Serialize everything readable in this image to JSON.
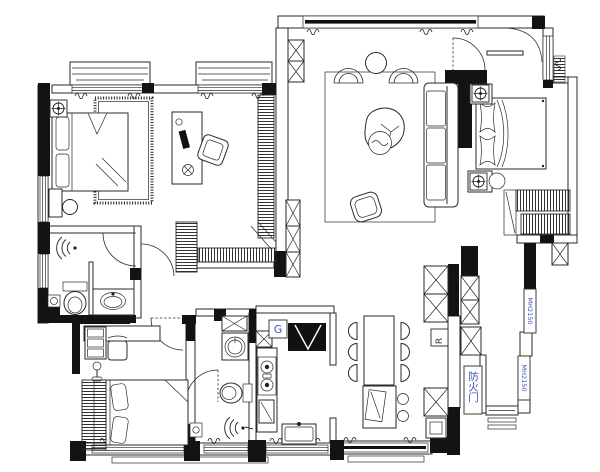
{
  "drawing": {
    "type": "residential floor plan"
  },
  "labels": {
    "fire_door": "防火门",
    "gas": "G",
    "fridge": "R",
    "window_code_top": "MH2150",
    "window_code_bottom": "MH2150"
  },
  "colors": {
    "wall": "#131313",
    "line": "#2a2a2a",
    "cad_label": "#3d55b8",
    "background": "#ffffff"
  }
}
